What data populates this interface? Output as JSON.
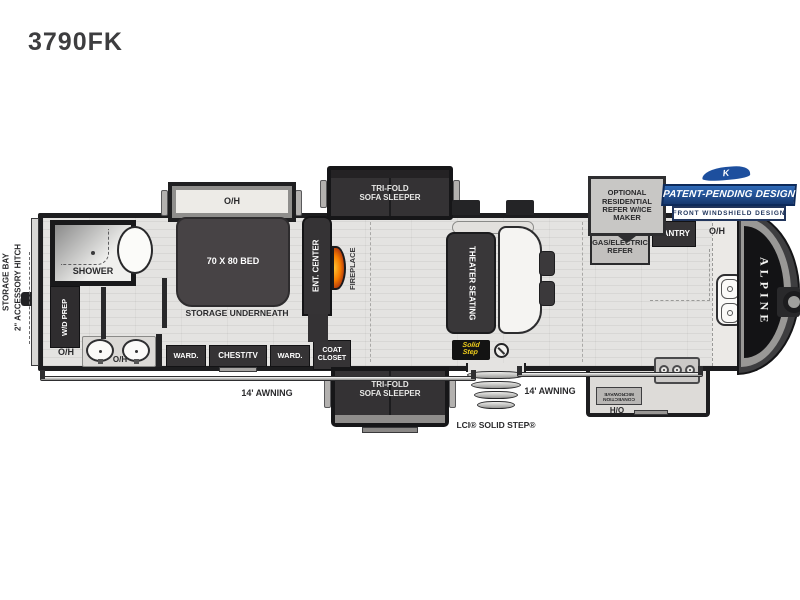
{
  "model": "3790FK",
  "callouts": {
    "optional_refer": "OPTIONAL\nRESIDENTIAL\nREFER W/ICE\nMAKER",
    "patent_logo_letter": "K",
    "patent_title": "PATENT-PENDING DESIGN",
    "patent_subtitle": "FRONT WINDSHIELD DESIGN"
  },
  "labels": {
    "oh": "O/H",
    "ward": "WARD.",
    "awning": "14' AWNING",
    "trifold": "TRI-FOLD\nSOFA SLEEPER"
  },
  "exterior": {
    "storage_bay": "STORAGE BAY",
    "accessory_hitch": "2\" ACCESSORY HITCH",
    "brand": "ALPINE",
    "solid_step_caption": "LCI® SOLID STEP®",
    "solid_step_badge": "Solid\nStep"
  },
  "bedroom": {
    "bed": "70 X 80 BED",
    "storage": "STORAGE UNDERNEATH",
    "chest_tv": "CHEST/TV",
    "coat_closet": "COAT\nCLOSET"
  },
  "bath": {
    "shower": "SHOWER",
    "wd_prep": "W/D PREP"
  },
  "living": {
    "ent_center": "ENT. CENTER",
    "fireplace": "FIREPLACE",
    "theater": "THEATER SEATING"
  },
  "kitchen": {
    "refer": "18 CU. FT.\nGAS/ELECTRIC\nREFER",
    "pantry": "PANTRY",
    "microwave": "CONVECTION\nMICROWAVE"
  },
  "colors": {
    "badge_blue": "#1d4f9e",
    "flame_orange": "#f57c00",
    "step_yellow": "#f6d31c",
    "wall_dark": "#1d1d1f"
  }
}
